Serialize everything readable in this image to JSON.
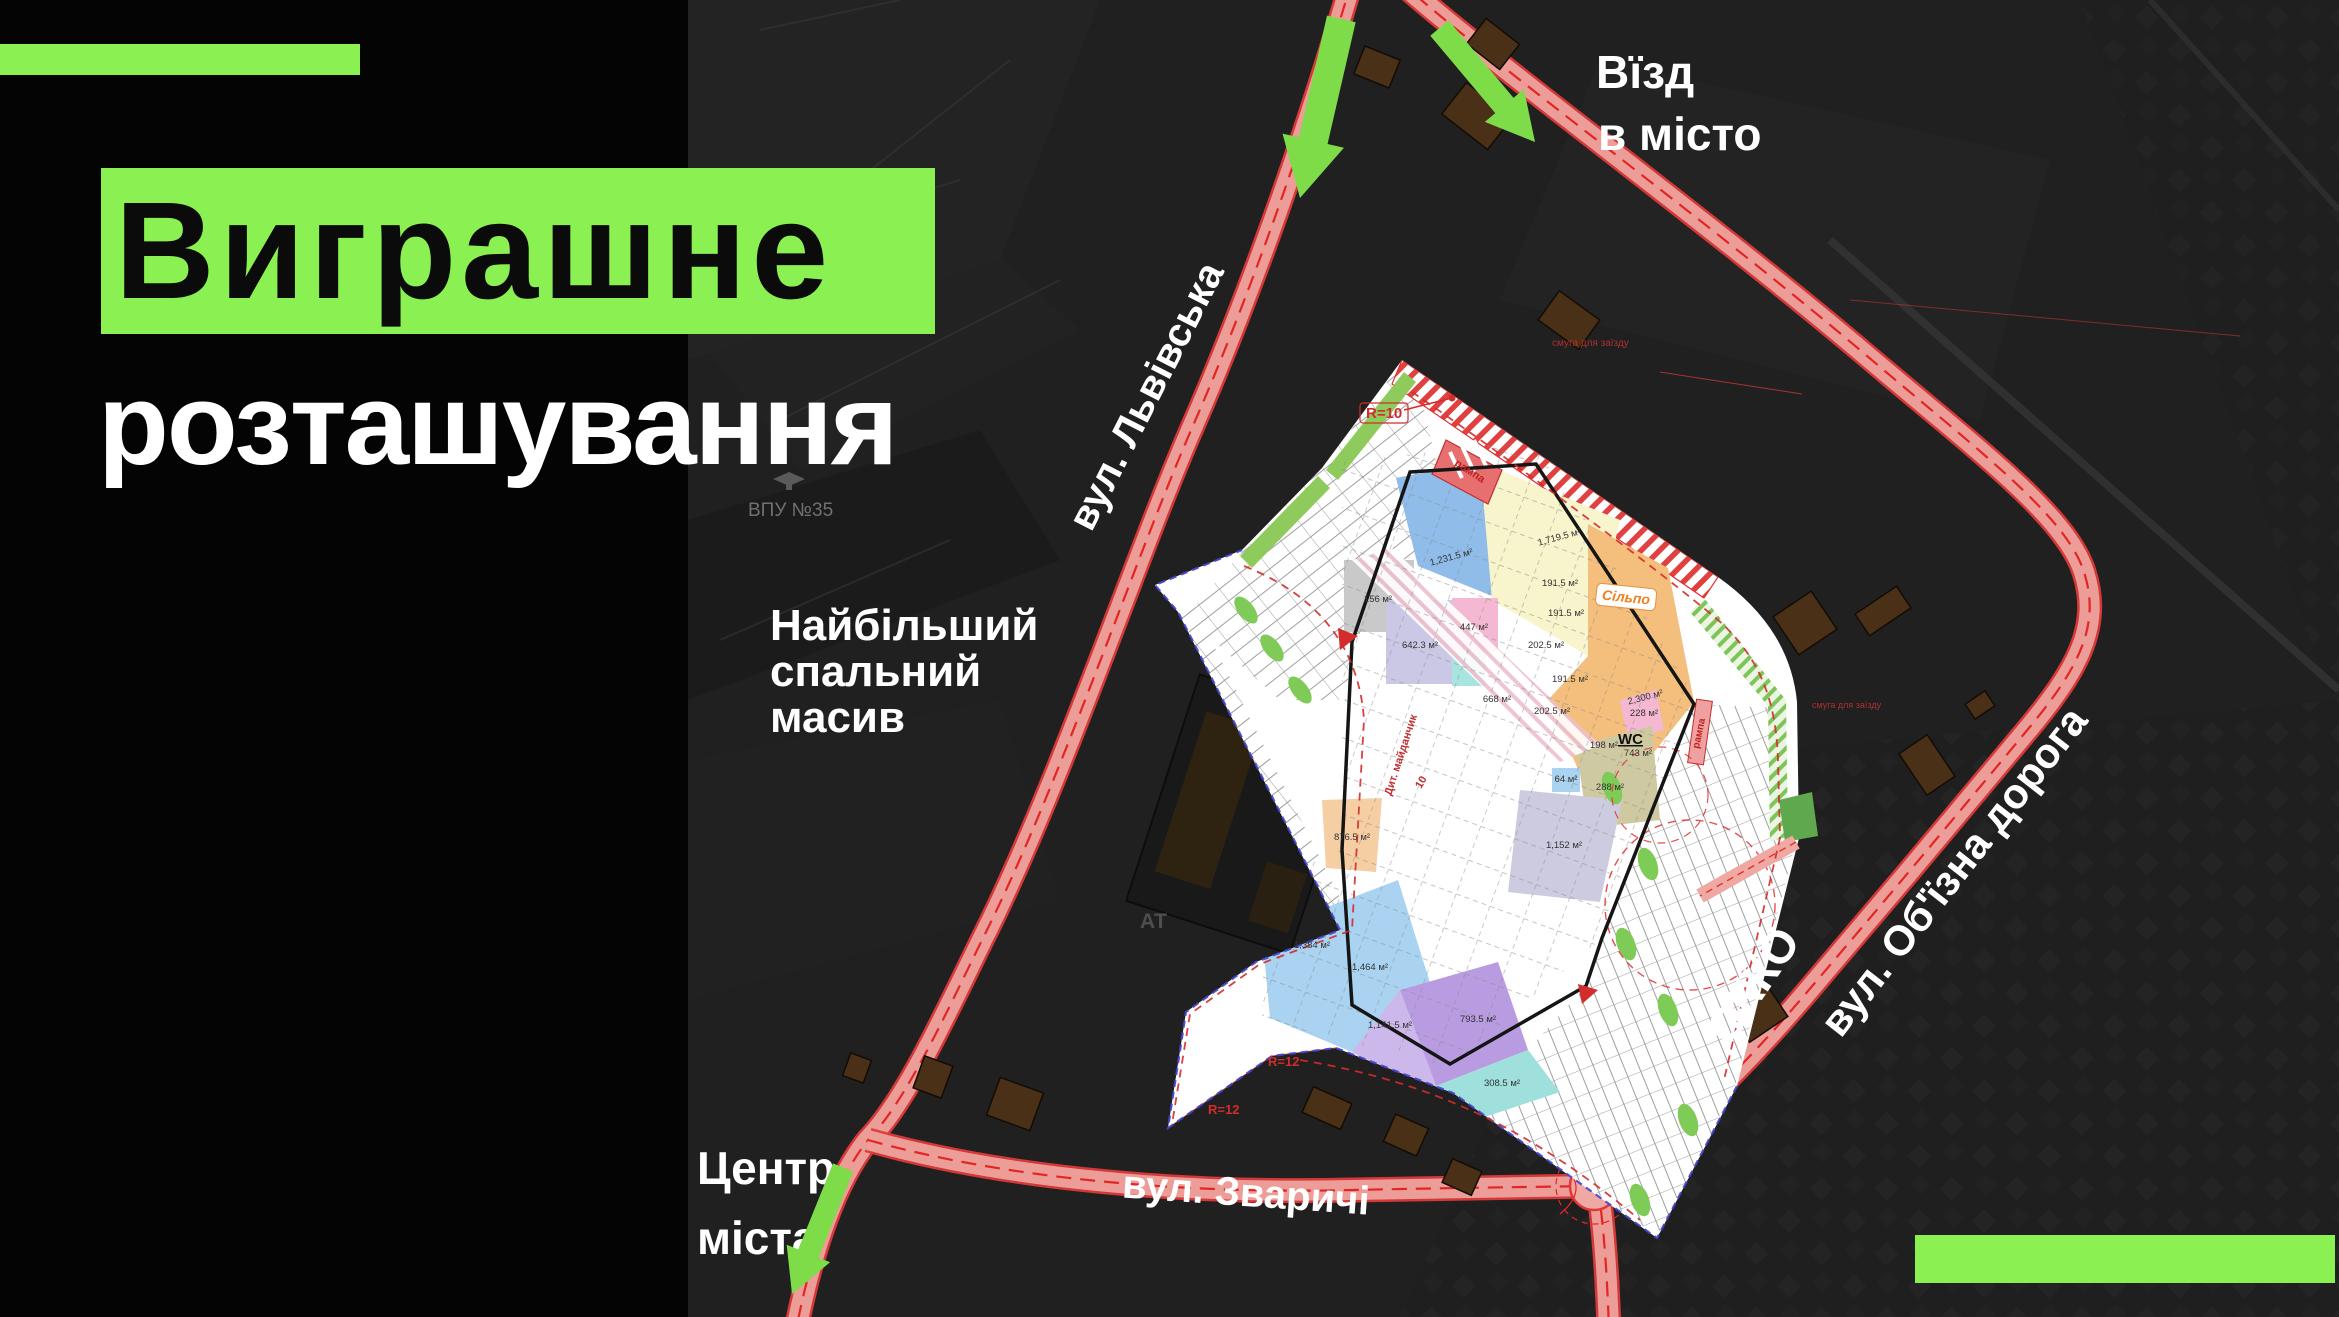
{
  "panel": {
    "title": "Виграшне",
    "subtitle": "розташування"
  },
  "accent": {
    "green": "#8BF152",
    "arrow_green": "#7EDC49",
    "road_red": "#E03131"
  },
  "map_labels": {
    "entry_line1": "Вїзд",
    "entry_line2": "в місто",
    "lvivska": "вул. Львівська",
    "district_line1": "Найбільший",
    "district_line2": "спальний",
    "district_line3": "масив",
    "center_line1": "Центр",
    "center_line2": "міста",
    "zvarychi": "вул. Зваричі",
    "obyizna": "вул. Об'їзна дорога",
    "okko": "ОККО",
    "vpu": "ВПУ №35",
    "at": "АТ"
  },
  "plan_labels": {
    "r10": "R=10",
    "r12a": "R=12",
    "r12b": "R=12",
    "rampa1": "рампа",
    "rampa2": "рампа",
    "wc": "WC",
    "silpo": "Сільпо",
    "playground": "Дит. майданчик",
    "small10": "10",
    "anno1": "смуга для заїзду",
    "anno2": "смуга для заїзду",
    "areas": [
      {
        "t": "1,231.5 м²",
        "x": 1452,
        "y": 560,
        "r": -15
      },
      {
        "t": "1,719.5 м²",
        "x": 1560,
        "y": 540,
        "r": -15
      },
      {
        "t": "2,300 м²",
        "x": 1646,
        "y": 700,
        "r": -15
      },
      {
        "t": "156 м²",
        "x": 1378,
        "y": 602
      },
      {
        "t": "642.3 м²",
        "x": 1420,
        "y": 648
      },
      {
        "t": "447 м²",
        "x": 1474,
        "y": 630
      },
      {
        "t": "668 м²",
        "x": 1497,
        "y": 702
      },
      {
        "t": "191.5 м²",
        "x": 1560,
        "y": 586
      },
      {
        "t": "191.5 м²",
        "x": 1566,
        "y": 616
      },
      {
        "t": "202.5 м²",
        "x": 1546,
        "y": 648
      },
      {
        "t": "191.5 м²",
        "x": 1570,
        "y": 682
      },
      {
        "t": "202.5 м²",
        "x": 1552,
        "y": 714
      },
      {
        "t": "876.5 м²",
        "x": 1352,
        "y": 840
      },
      {
        "t": "1,384 м²",
        "x": 1312,
        "y": 948
      },
      {
        "t": "1,464 м²",
        "x": 1370,
        "y": 970
      },
      {
        "t": "1,141.5 м²",
        "x": 1390,
        "y": 1028
      },
      {
        "t": "793.5 м²",
        "x": 1478,
        "y": 1022
      },
      {
        "t": "308.5 м²",
        "x": 1502,
        "y": 1086
      },
      {
        "t": "1,152 м²",
        "x": 1564,
        "y": 848
      },
      {
        "t": "743 м²",
        "x": 1638,
        "y": 756
      },
      {
        "t": "198 м²",
        "x": 1604,
        "y": 748
      },
      {
        "t": "288 м²",
        "x": 1610,
        "y": 790
      },
      {
        "t": "64 м²",
        "x": 1566,
        "y": 782
      },
      {
        "t": "228 м²",
        "x": 1644,
        "y": 716
      }
    ]
  }
}
